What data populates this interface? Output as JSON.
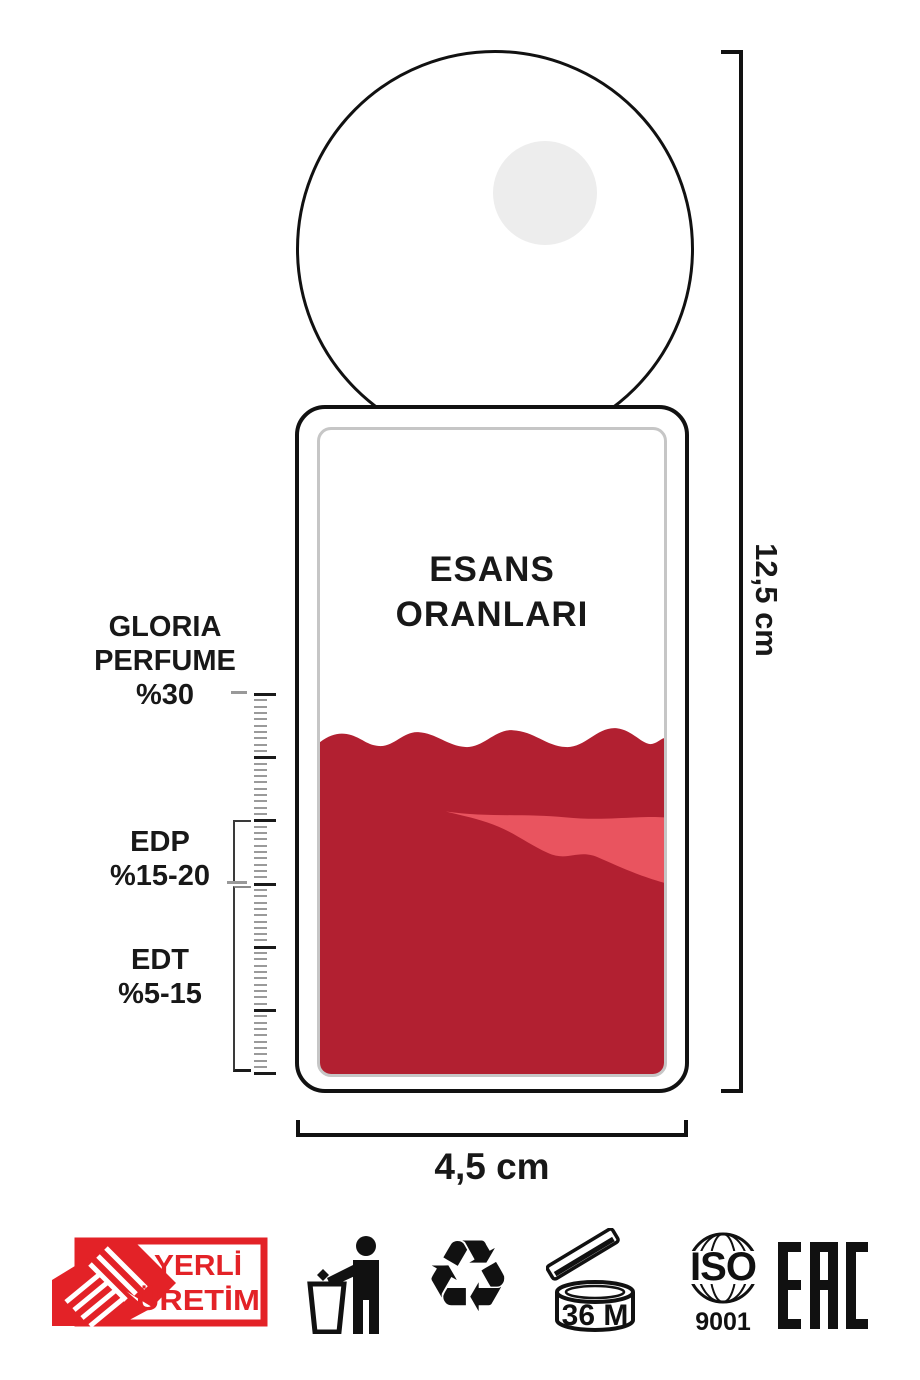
{
  "bottle": {
    "title": [
      "ESANS",
      "ORANLARI"
    ],
    "height_label": "12,5 cm",
    "width_label": "4,5 cm"
  },
  "scale": {
    "levels": [
      {
        "name": "gloria-perfume",
        "lines": [
          "GLORIA",
          "PERFUME",
          "%30"
        ]
      },
      {
        "name": "edp",
        "lines": [
          "EDP",
          "%15-20"
        ]
      },
      {
        "name": "edt",
        "lines": [
          "EDT",
          "%5-15"
        ]
      }
    ]
  },
  "ruler": {
    "tick_count": 61,
    "major_every": 10,
    "spacing_px": 6.32
  },
  "badges": {
    "yerli_uretim": [
      "YERLİ",
      "ÜRETİM"
    ],
    "pao_label": "36 M",
    "iso_label": "ISO",
    "iso_number": "9001",
    "eac_label": "EAC"
  },
  "icons": {
    "recycle": "♻"
  },
  "colors": {
    "liquid": "#b22031",
    "liquid_highlight": "#e9545f",
    "badge_red": "#e32227",
    "cap_highlight": "#ededed",
    "inner_border": "#c6c6c6"
  }
}
